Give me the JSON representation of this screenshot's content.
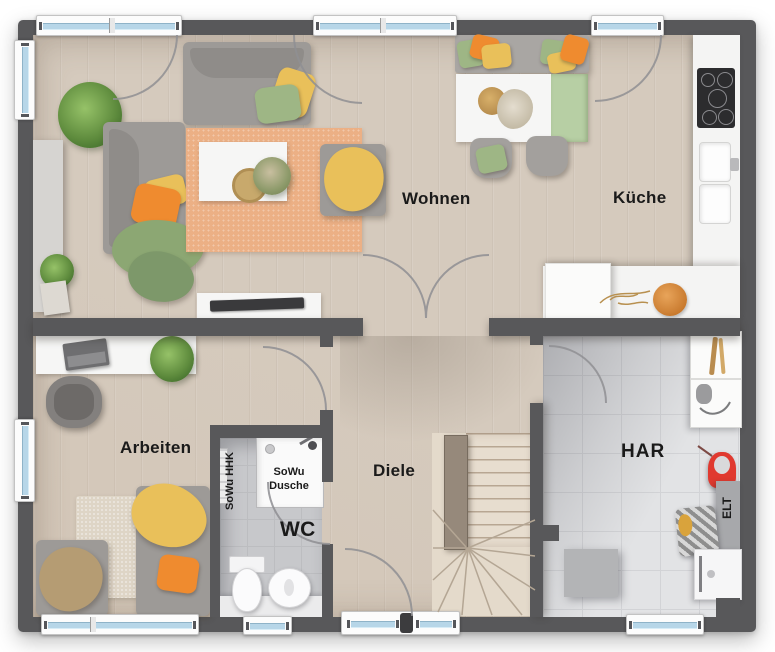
{
  "rooms": {
    "wohnen": {
      "label": "Wohnen"
    },
    "kueche": {
      "label": "Küche"
    },
    "arbeiten": {
      "label": "Arbeiten"
    },
    "diele": {
      "label": "Diele"
    },
    "wc": {
      "label": "WC"
    },
    "har": {
      "label": "HAR"
    }
  },
  "fixtures": {
    "shower_label_line1": "SoWu",
    "shower_label_line2": "Dusche",
    "radiator_label": "SoWu HHK",
    "electrical_label": "ELT"
  },
  "colors": {
    "wall": "#58585a",
    "wood_floor": "#d5cabd",
    "tile_floor": "#e2e3e5",
    "tile_grout": "#d2d3d6",
    "bath_tile": "#c7c8cb",
    "bath_grout": "#bcbdc0",
    "window_glass": "#b7d6e8",
    "rug_living": "#ecb085",
    "rug_office": "#ded5c6",
    "accent_orange": "#ef8b2f",
    "accent_yellow": "#e9c05a",
    "accent_green": "#9eb685",
    "blanket_green": "#8ca773",
    "blanket_tan": "#b59c73",
    "vacuum_red": "#e0392f"
  }
}
